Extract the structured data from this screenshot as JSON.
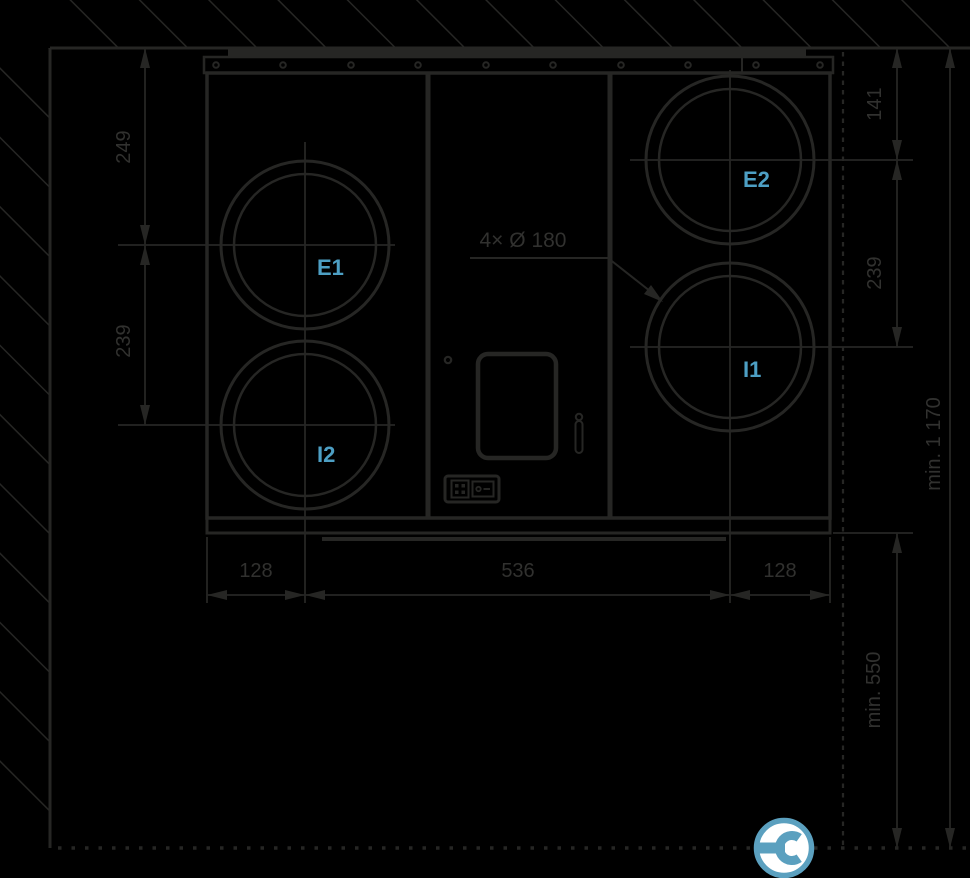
{
  "colors": {
    "background": "#000000",
    "line": "#262624",
    "dim_text": "#31312f",
    "port_label": "#4d9fc4",
    "icon_blue": "#5ba0bf",
    "icon_fill": "#ffffff"
  },
  "unit": {
    "ports": {
      "e1": "E1",
      "e2": "E2",
      "i1": "I1",
      "i2": "I2"
    },
    "duct_callout": "4× Ø 180"
  },
  "dimensions": {
    "left_top": "249",
    "left_middle": "239",
    "bottom_left": "128",
    "bottom_center": "536",
    "bottom_right": "128",
    "right_top": "141",
    "right_middle": "239",
    "right_floor_clearance": "min. 550",
    "right_total": "min. 1 170"
  },
  "icons": {
    "service_wrench": "service-wrench-icon"
  }
}
